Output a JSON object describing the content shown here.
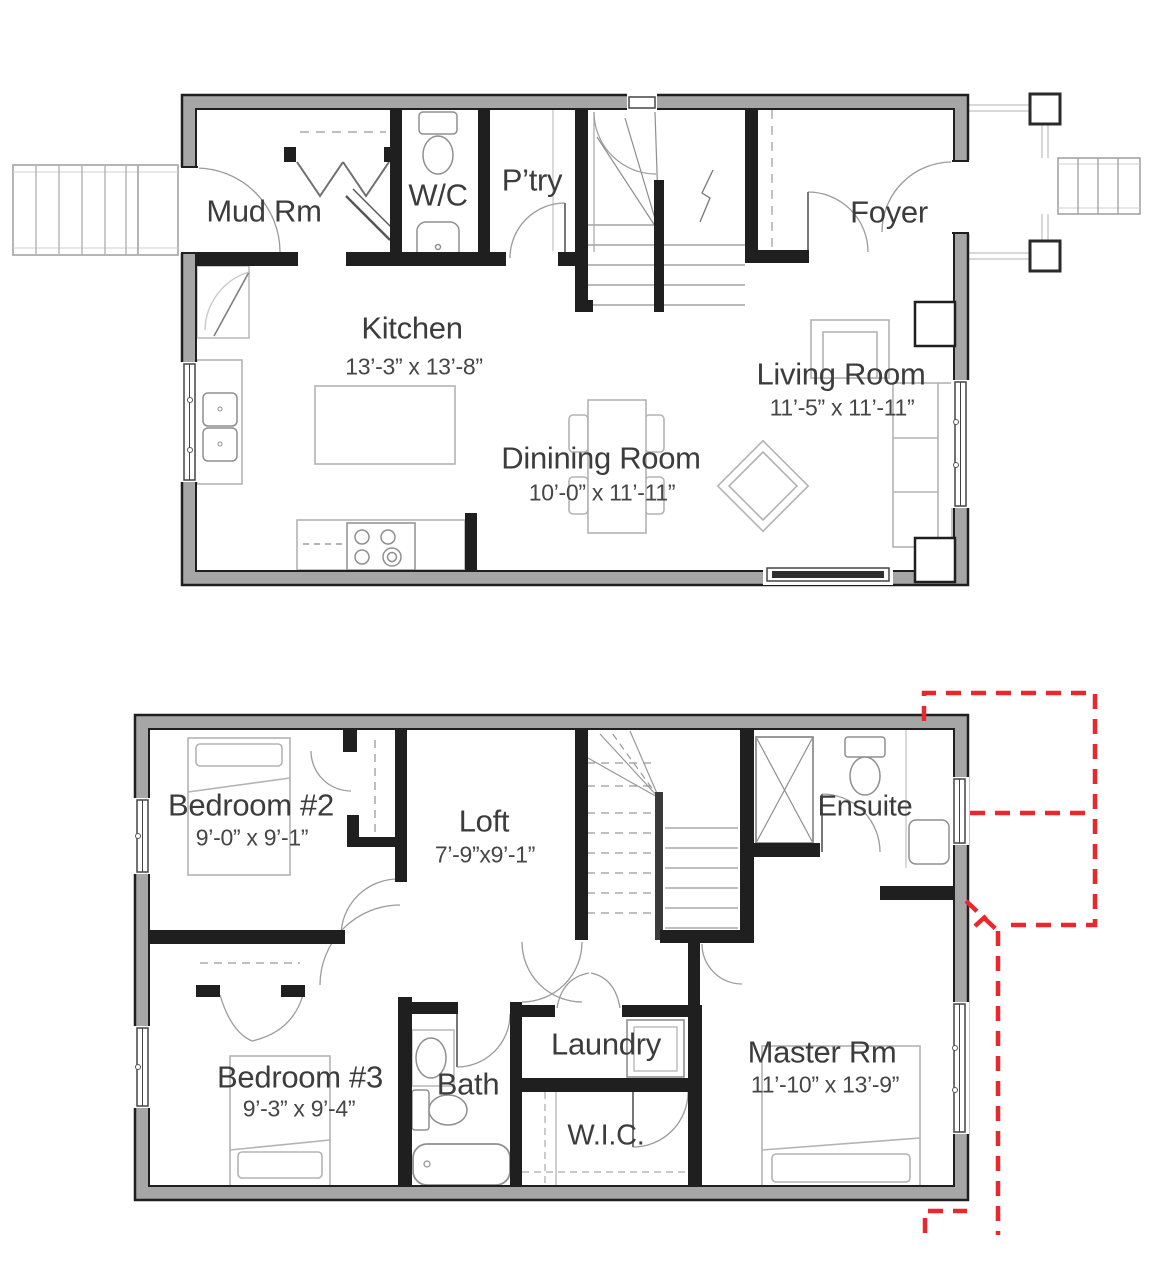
{
  "f1": {
    "mud": "Mud Rm",
    "wc": "W/C",
    "ptry": "P’try",
    "foyer": "Foyer",
    "kitchen": "Kitchen",
    "kitchen_dims": "13’-3” x  13’-8”",
    "living": "Living Room",
    "living_dims": "11’-5” x  11’-11”",
    "dining": "Dinining Room",
    "dining_dims": "10’-0” x  11’-11”"
  },
  "f2": {
    "bedroom2": "Bedroom #2",
    "bedroom2_dims": "9’-0” x  9’-1”",
    "loft": "Loft",
    "loft_dims": "7’-9”x9’-1”",
    "ensuite": "Ensuite",
    "bedroom3": "Bedroom #3",
    "bedroom3_dims": "9’-3” x  9’-4”",
    "bath": "Bath",
    "laundry": "Laundry",
    "wic": "W.I.C.",
    "master": "Master Rm",
    "master_dims": "11’-10” x  13’-9”"
  },
  "colors": {
    "wall_fill": "#a6a6a6",
    "wall_edge": "#1f1f1f",
    "revision_dash": "#e8282c",
    "text": "#3c3c3c"
  }
}
